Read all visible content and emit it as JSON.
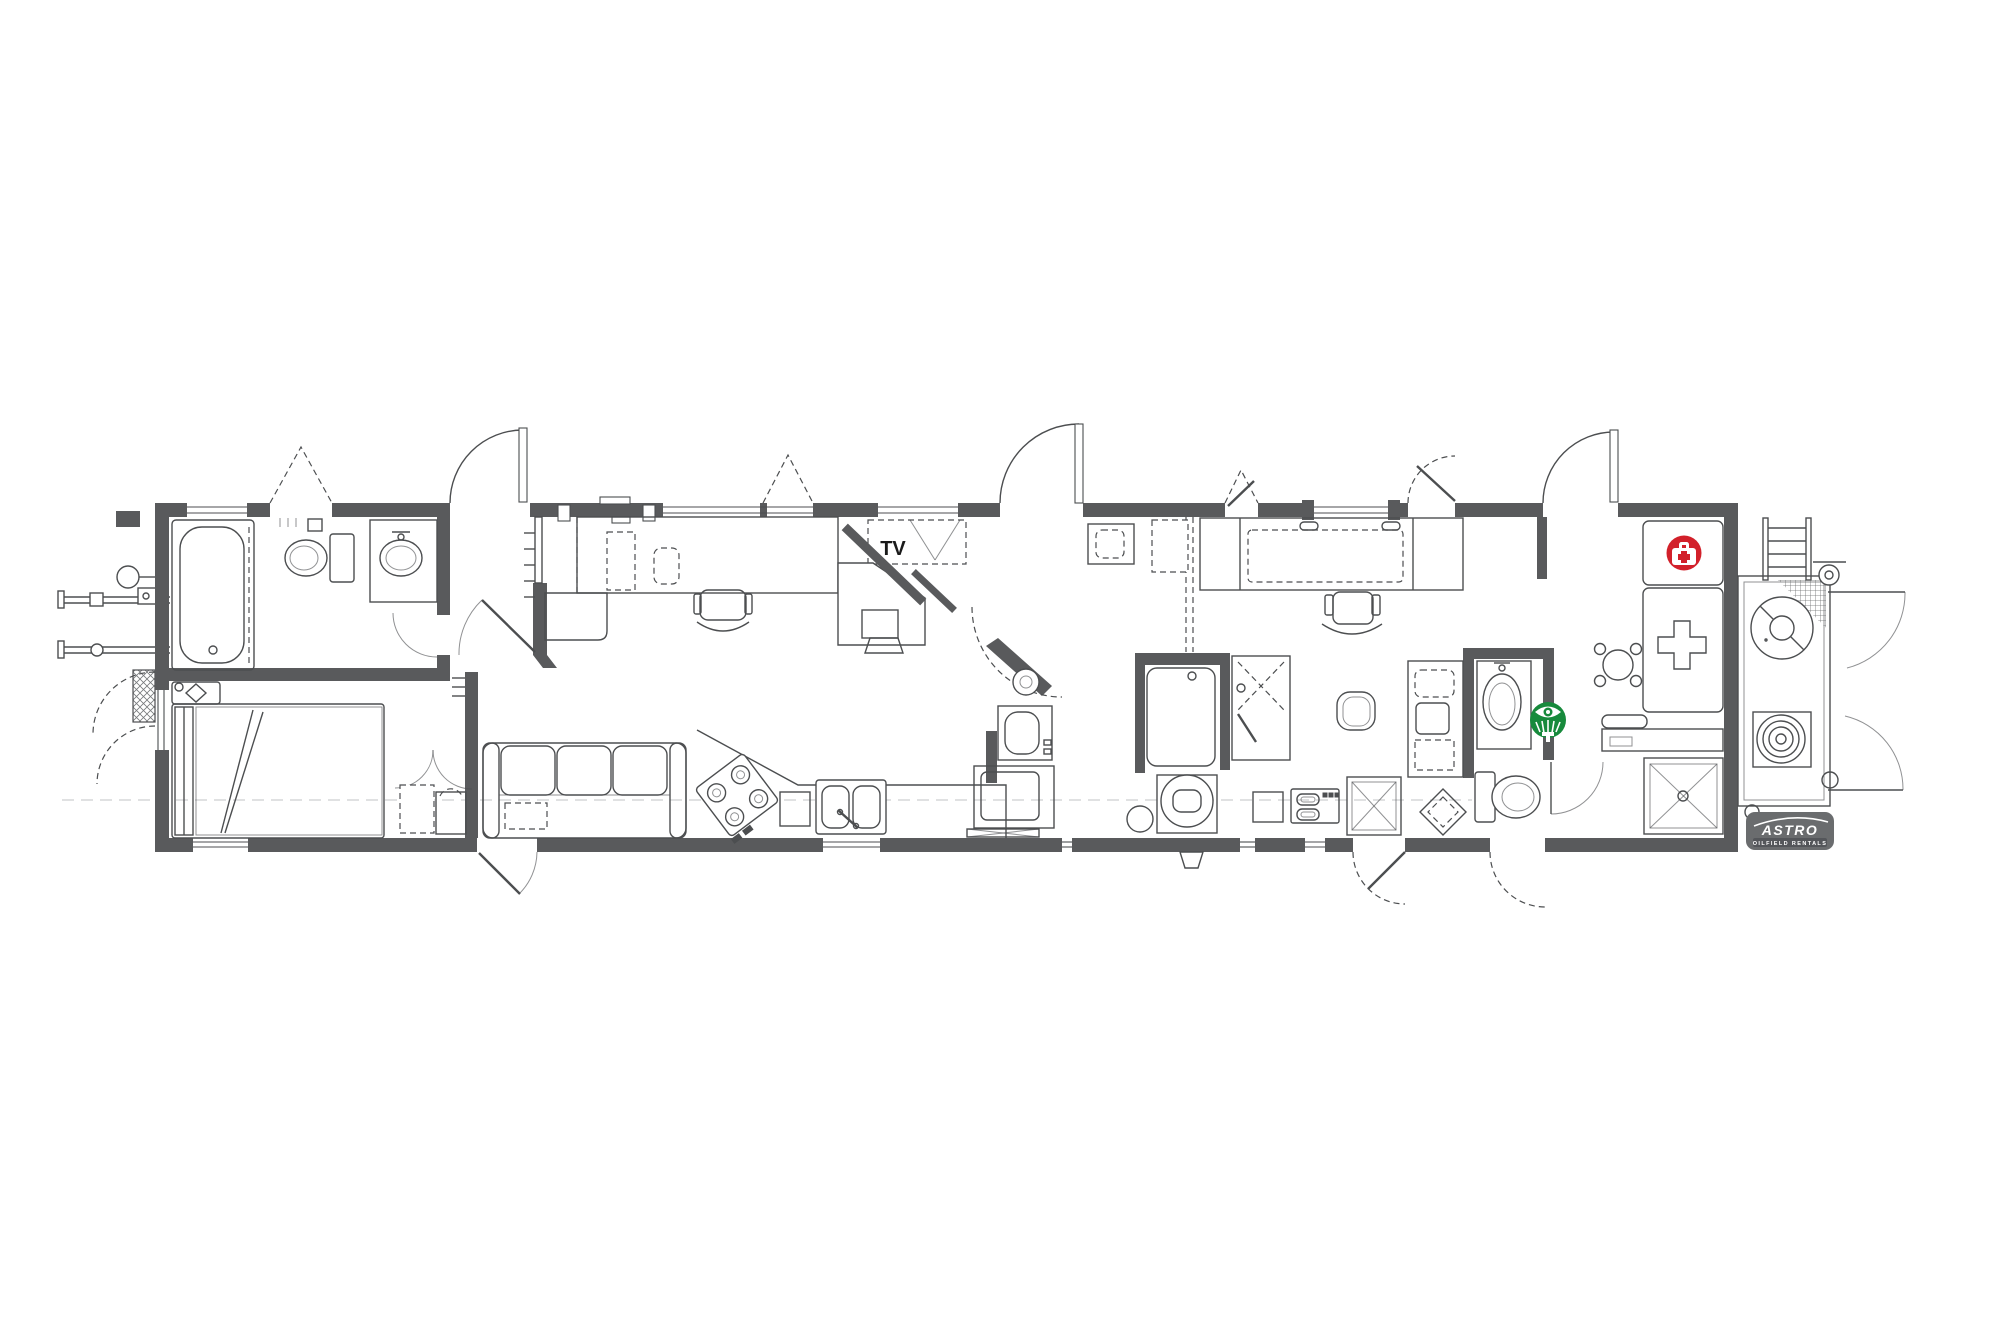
{
  "image": {
    "type": "architectural-floor-plan",
    "subject": "single-wide oilfield rental trailer / wellsite medic unit floor plan",
    "background": "#ffffff"
  },
  "labels": {
    "tv": "TV"
  },
  "logo": {
    "brand": "ASTRO",
    "tagline": "OILFIELD RENTALS",
    "bg": "#6a6c6e",
    "band": "#54565a",
    "text_color": "#ffffff"
  },
  "icons": {
    "first_aid": {
      "name": "first-aid-icon",
      "shape": "circle",
      "glyph": "medical-kit-with-cross",
      "color": "#d2202a",
      "glyph_color": "#ffffff"
    },
    "eyewash": {
      "name": "eyewash-icon",
      "shape": "circle",
      "glyph": "eye-wash-station",
      "color": "#178a3c",
      "glyph_color": "#ffffff"
    }
  },
  "colors": {
    "wall": "#595a5c",
    "line": "#4c4e50",
    "line_light": "#8f9193",
    "background": "#ffffff"
  }
}
